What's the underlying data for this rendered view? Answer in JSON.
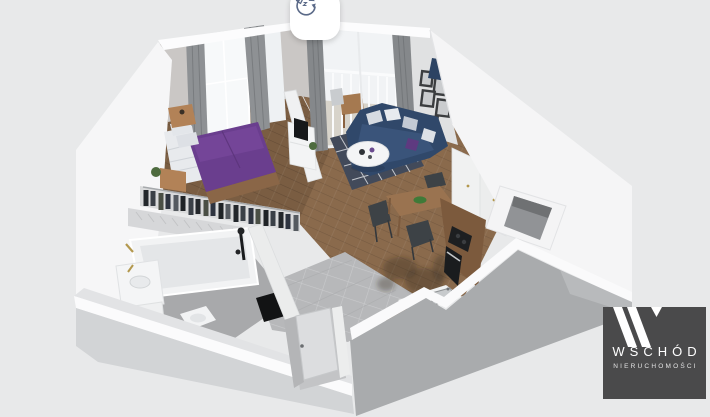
{
  "canvas": {
    "width": 710,
    "height": 417,
    "background_color": "#e8e9ea"
  },
  "view_controls": {
    "rotate_button": {
      "icon": "rotate-3d-icon",
      "background_color": "#ffffff",
      "icon_color": "#5b6a88"
    }
  },
  "watermark": {
    "monogram": "W",
    "brand": "WSCHÓD",
    "tagline": "NIERUCHOMOŚCI",
    "background_color": "#4a4a4b",
    "text_color": "#ffffff",
    "tagline_color": "#e3e3e3"
  },
  "scene": {
    "type": "3d-apartment-floorplan",
    "rooms": [
      {
        "name": "bedroom",
        "furniture": [
          "double-bed-purple-bedding",
          "white-sheets-pillows",
          "wood-nightstands",
          "open-wardrobe-hanging-clothes",
          "tall-window-gray-curtains",
          "radiator",
          "plant"
        ]
      },
      {
        "name": "living-room",
        "furniture": [
          "navy-corner-sofa",
          "gray-white-cushions",
          "purple-cushion",
          "white-round-coffee-table",
          "dark-patterned-rug",
          "tv-cabinet-with-tv",
          "gallery-wall-frames",
          "navy-armchair"
        ]
      },
      {
        "name": "balcony",
        "furniture": [
          "white-railing",
          "wood-bistro-table",
          "chair",
          "glass-door-gray-curtains"
        ]
      },
      {
        "name": "kitchen",
        "furniture": [
          "tall-white-cabinets",
          "wood-countertop",
          "black-cooktop",
          "built-in-oven",
          "steel-sink"
        ]
      },
      {
        "name": "dining-area",
        "furniture": [
          "wood-table",
          "black-chairs",
          "green-bowl"
        ]
      },
      {
        "name": "bathroom",
        "furniture": [
          "bathtub",
          "black-shower-fixture",
          "vanity-with-sink",
          "gold-taps",
          "washing-machine",
          "toilet",
          "dark-mirror-panel",
          "herringbone-tile-wall"
        ]
      },
      {
        "name": "hallway",
        "furniture": [
          "gray-floor-tiles",
          "entry-door",
          "person-shadow-on-floor"
        ]
      },
      {
        "name": "utility",
        "furniture": [
          "ventilation-shaft"
        ]
      }
    ],
    "palette": {
      "background": "#e8e9ea",
      "exterior_wall": "#f6f6f7",
      "wall_top": "#fbfbfc",
      "front_wall_shadow": "#a9abad",
      "interior_wall": "#e0e1e2",
      "bedroom_wall": "#cac7c5",
      "wood_floor": "#8a6a4c",
      "bedroom_floor": "#7a5d42",
      "tile_floor": "#b7b8ba",
      "bath_floor": "#a8a9ab",
      "balcony_floor": "#d8d4cc",
      "bed": "#6a3e8e",
      "sofa": "#30486a",
      "rug": "#424a5a",
      "accent_pillow": "#5e3a80",
      "wood_furniture": "#9a7350",
      "counter_wood": "#7c5a3d",
      "cabinet": "#f1f2f2",
      "appliance": "#1c1e20",
      "curtain": "#8e9194",
      "window": "#f7f9fa",
      "gold": "#b3984e"
    }
  }
}
